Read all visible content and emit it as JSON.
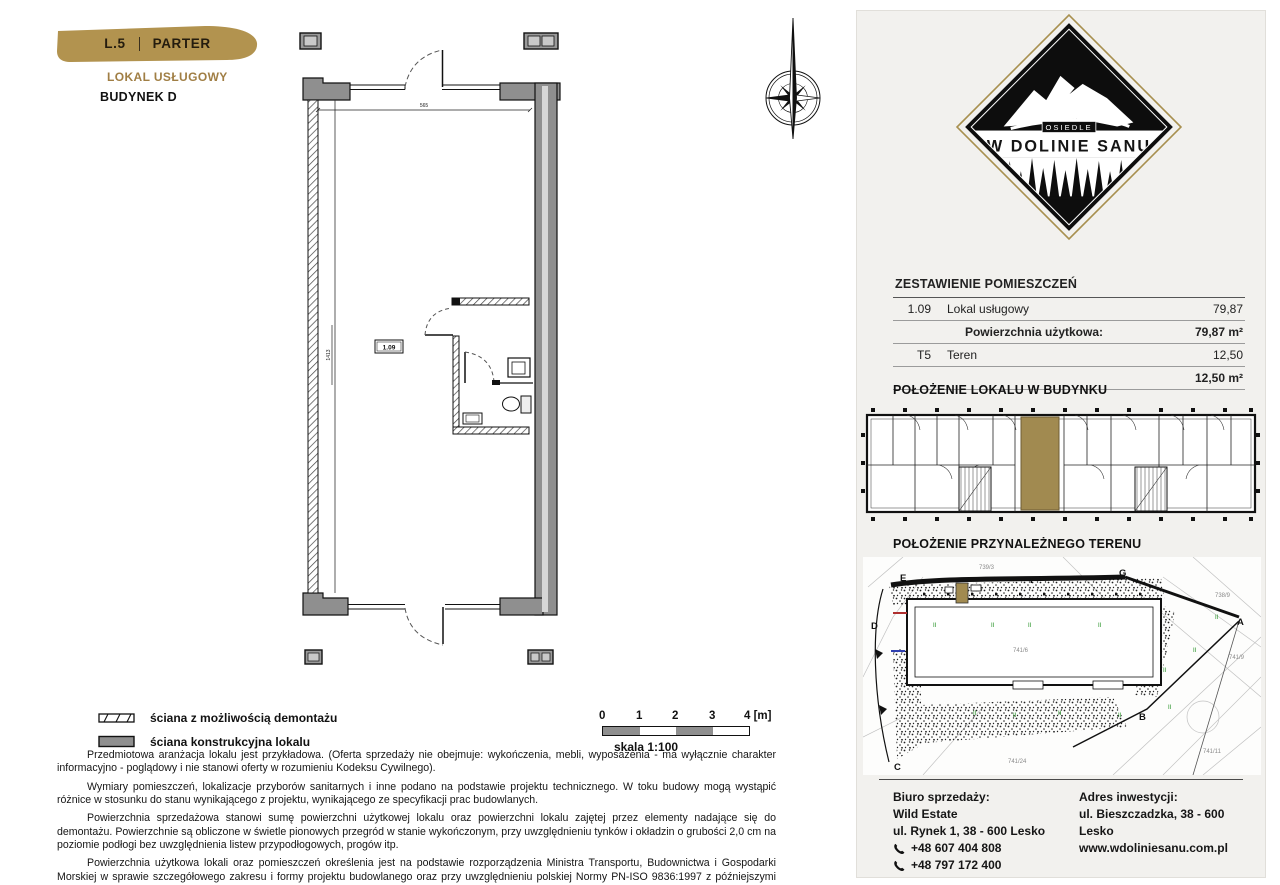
{
  "header": {
    "badge_code": "L.5",
    "badge_level": "PARTER",
    "subtitle": "LOKAL USŁUGOWY",
    "building": "BUDYNEK D"
  },
  "plan": {
    "room_label": "1.09",
    "dim_top": "565",
    "dim_side": "1413"
  },
  "legend": {
    "items": [
      "ściana z możliwością demontażu",
      "ściana konstrukcyjna lokalu"
    ]
  },
  "scalebar": {
    "ticks": [
      "0",
      "1",
      "2",
      "3",
      "4 [m]"
    ],
    "label": "skala 1:100"
  },
  "disclaimer": {
    "p1": "Przedmiotowa aranżacja lokalu jest przykładowa. (Oferta sprzedaży nie obejmuje: wykończenia, mebli, wyposażenia - ma wyłącznie charakter informacyjno - poglądowy i nie stanowi oferty w rozumieniu Kodeksu Cywilnego).",
    "p2": "Wymiary pomieszczeń, lokalizacje przyborów sanitarnych i inne podano na podstawie projektu technicznego. W toku budowy mogą wystąpić różnice w stosunku do stanu wynikającego z projektu, wynikającego ze specyfikacji prac budowlanych.",
    "p3": "Powierzchnia sprzedażowa stanowi sumę powierzchni użytkowej lokalu oraz powierzchni lokalu zajętej przez elementy nadające się do demontażu. Powierzchnie są obliczone w świetle pionowych przegród w stanie wykończonym, przy uwzględnieniu tynków i okładzin o grubości 2,0 cm na poziomie podłogi bez uwzględnienia listew przypodłogowych, progów itp.",
    "p4": "Powierzchnia użytkowa lokali oraz pomieszczeń określenia jest na podstawie rozporządzenia Ministra Transportu, Budownictwa i Gospodarki Morskiej w sprawie szczegółowego zakresu i formy projektu budowlanego oraz przy uwzględnieniu polskiej Normy PN-ISO 9836:1997 z późniejszymi zmianami."
  },
  "logo": {
    "estate_word": "OSIEDLE",
    "name": "W DOLINIE SANU"
  },
  "rooms_table": {
    "title": "ZESTAWIENIE POMIESZCZEŃ",
    "rows": [
      {
        "code": "1.09",
        "name": "Lokal usługowy",
        "value": "79,87"
      },
      {
        "code": "",
        "name": "Powierzchnia użytkowa:",
        "value": "79,87 m²"
      },
      {
        "code": "T5",
        "name": "Teren",
        "value": "12,50"
      },
      {
        "code": "",
        "name": "",
        "value": "12,50 m²"
      }
    ]
  },
  "sections": {
    "building": "POŁOŻENIE LOKALU W BUDYNKU",
    "site": "POŁOŻENIE PRZYNALEŻNEGO TERENU"
  },
  "site": {
    "markers": [
      "A",
      "B",
      "C",
      "D",
      "E",
      "F",
      "G"
    ],
    "parcels": [
      "739/3",
      "738/9",
      "741/6",
      "741/9",
      "741/24",
      "741/11"
    ],
    "tick": "II"
  },
  "contact": {
    "office_title": "Biuro sprzedaży:",
    "office_name": "Wild Estate",
    "office_address": "ul. Rynek 1, 38 - 600 Lesko",
    "phone1": "+48 607 404 808",
    "phone2": "+48 797 172 400",
    "invest_title": "Adres inwestycji:",
    "invest_address": "ul. Bieszczadzka, 38 - 600 Lesko",
    "website": "www.wdoliniesanu.com.pl"
  },
  "colors": {
    "gold": "#b2934f",
    "gold_text": "#a07e44",
    "highlight": "#a18a50",
    "panel_bg": "#f2f1ee",
    "wall_gray": "#8f8f8f"
  }
}
